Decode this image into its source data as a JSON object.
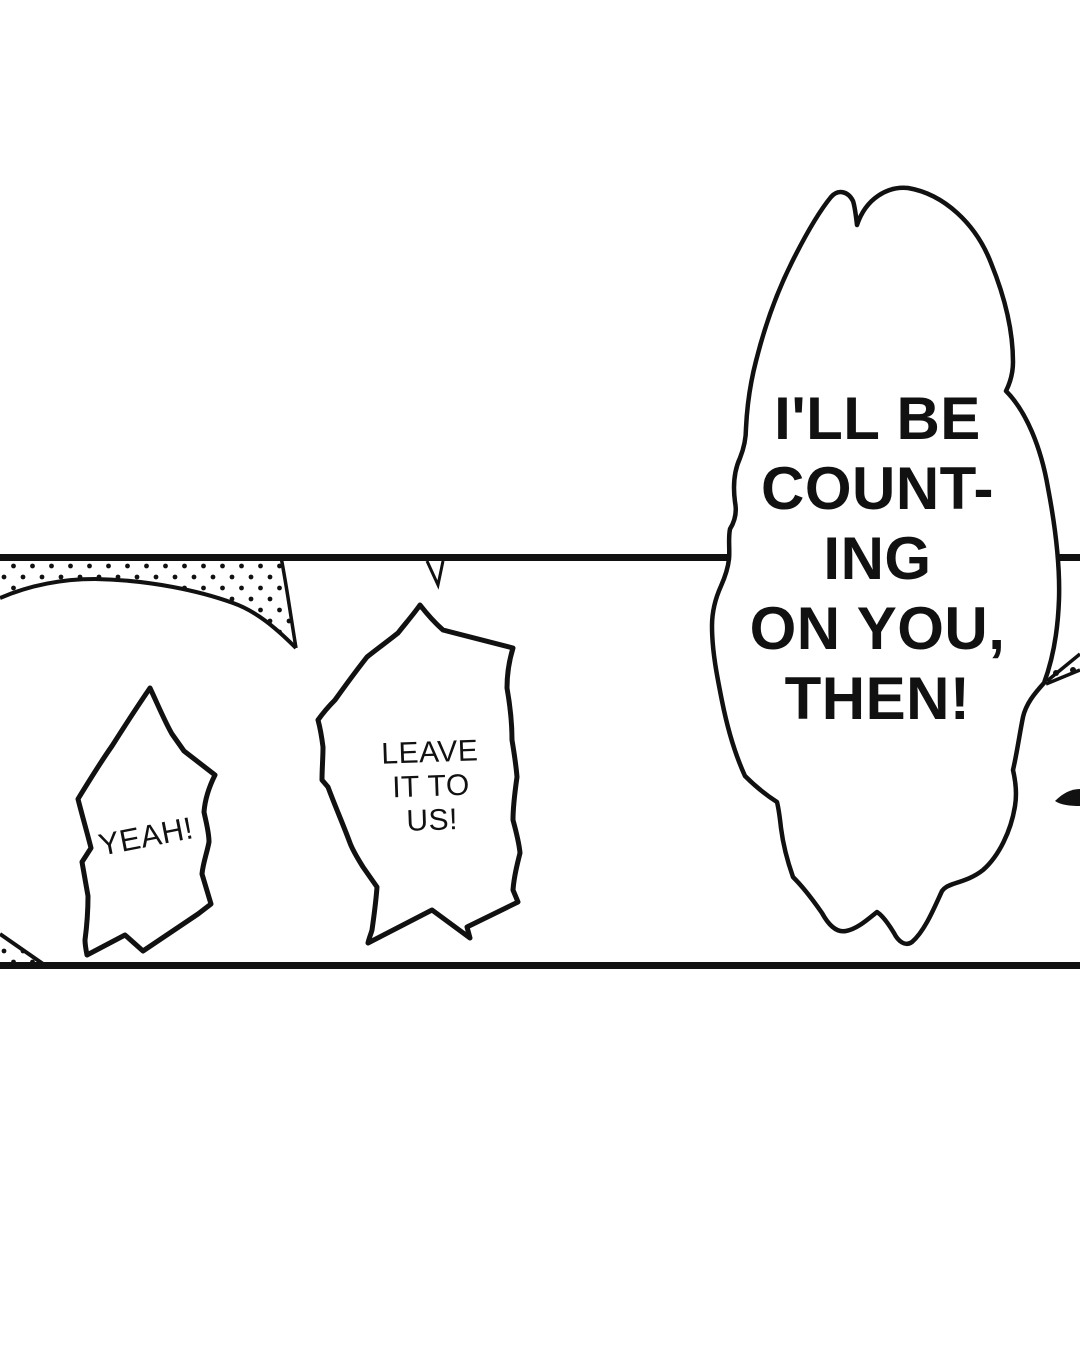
{
  "colors": {
    "ink": "#111111",
    "paper": "#ffffff"
  },
  "bubbles": {
    "main": {
      "lines": [
        "I'LL BE",
        "COUNT-",
        "ING",
        "ON YOU,",
        "THEN!"
      ]
    },
    "yeah": {
      "text": "YEAH!"
    },
    "leave": {
      "lines": [
        "LEAVE",
        "IT TO",
        "US!"
      ]
    }
  }
}
